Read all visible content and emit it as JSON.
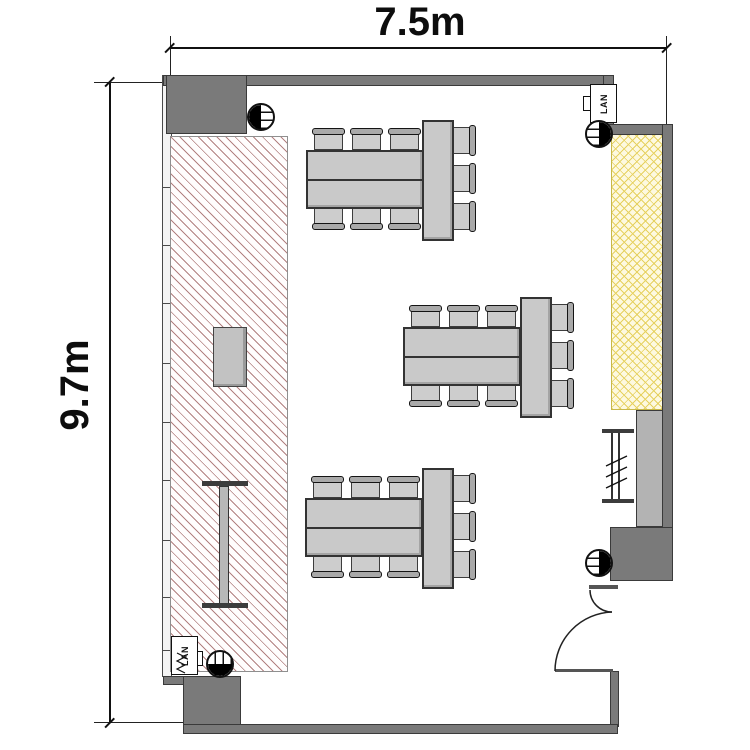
{
  "dimensions": {
    "width_label": "7.5m",
    "height_label": "9.7m"
  },
  "labels": {
    "lan_top": "LAN",
    "lan_bottom": "LAN"
  },
  "colors": {
    "wall": "#7a7a7a",
    "wall_border": "#3a3a3a",
    "furniture_fill": "#c9c9c9",
    "furniture_border": "#333333",
    "counter_hatch_line": "#b28181",
    "screen_hatch_line": "#e6d160",
    "screen_bg": "#fdf9e0",
    "cabinet_fill": "#b3b3b3"
  },
  "symbols": {
    "outlets": [
      {
        "id": "outlet-top-left",
        "fill_side": "left",
        "stripes": "horizontal"
      },
      {
        "id": "outlet-top-right",
        "fill_side": "right",
        "stripes": "horizontal"
      },
      {
        "id": "outlet-bottom-left",
        "fill_side": "bottom",
        "stripes": "vertical"
      },
      {
        "id": "outlet-bottom-right",
        "fill_side": "right",
        "stripes": "horizontal"
      }
    ],
    "lan_ports": 2,
    "door": {
      "location": "bottom-right",
      "type": "swing"
    }
  },
  "furniture": {
    "desk": {
      "w": 118,
      "h": 59
    },
    "end_table": {
      "w": 32,
      "h": 121
    },
    "chair_pitch": 38,
    "seats_per_group": 9,
    "table_groups": [
      {
        "name": "table-group-north",
        "desk": {
          "x": 306,
          "y": 150
        },
        "end": {
          "x": 422,
          "y": 120
        }
      },
      {
        "name": "table-group-center",
        "desk": {
          "x": 403,
          "y": 327
        },
        "end": {
          "x": 520,
          "y": 297
        }
      },
      {
        "name": "table-group-south",
        "desk": {
          "x": 305,
          "y": 498
        },
        "end": {
          "x": 422,
          "y": 468
        }
      }
    ]
  },
  "walls": {
    "left_wall_tick_ys": [
      187,
      245,
      303,
      363,
      422,
      480,
      540,
      597,
      650
    ]
  }
}
